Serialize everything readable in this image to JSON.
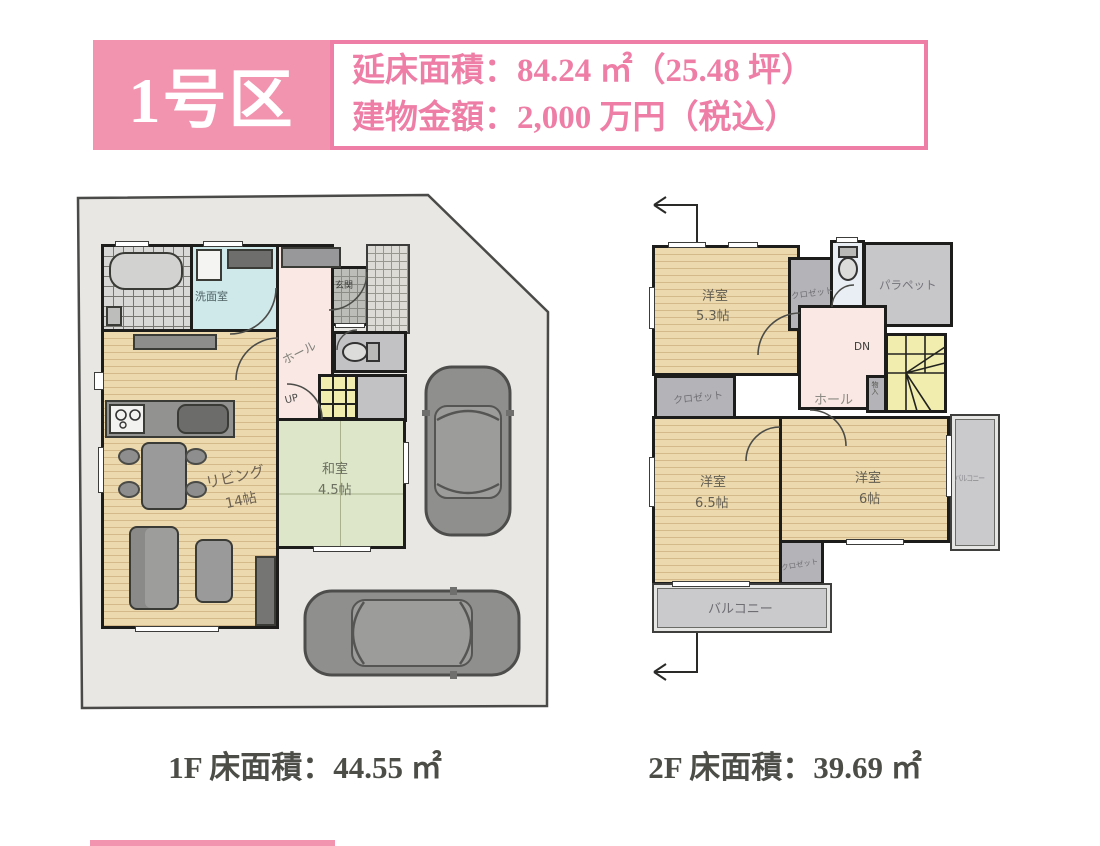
{
  "header": {
    "badge_label": "1号区",
    "info_line1": "延床面積：84.24 ㎡（25.48 坪）",
    "info_line2": "建物金額：2,000 万円（税込）"
  },
  "colors": {
    "badge_pink": "#f294b0",
    "accent_pink": "#ee7ea6",
    "caption_gray": "#4d4d48",
    "wood_floor": "#ecdaae",
    "tatami_green": "#dde6c8",
    "hall_pink": "#f9e8e4",
    "washroom_blue": "#cfe8ea",
    "stairs_yellow": "#f0edae",
    "lot_gray": "#e8e7e4"
  },
  "floor1": {
    "caption": "1F 床面積：44.55 ㎡",
    "labels": {
      "washroom": "洗面室",
      "entrance": "玄関",
      "hall": "ホール",
      "up": "UP",
      "living_name": "リビング",
      "living_size": "14帖",
      "washitsu_name": "和室",
      "washitsu_size": "4.5帖"
    }
  },
  "floor2": {
    "caption": "2F 床面積：39.69 ㎡",
    "labels": {
      "room53_name": "洋室",
      "room53_size": "5.3帖",
      "closet_top": "クロゼット",
      "parapet": "パラペット",
      "dn": "DN",
      "hall": "ホール",
      "storage": "物入",
      "closet_left": "クロゼット",
      "room65_name": "洋室",
      "room65_size": "6.5帖",
      "room6_name": "洋室",
      "room6_size": "6帖",
      "closet_bottom": "クロゼット",
      "balcony_bottom": "バルコニー",
      "balcony_right": "バルコニー"
    }
  }
}
